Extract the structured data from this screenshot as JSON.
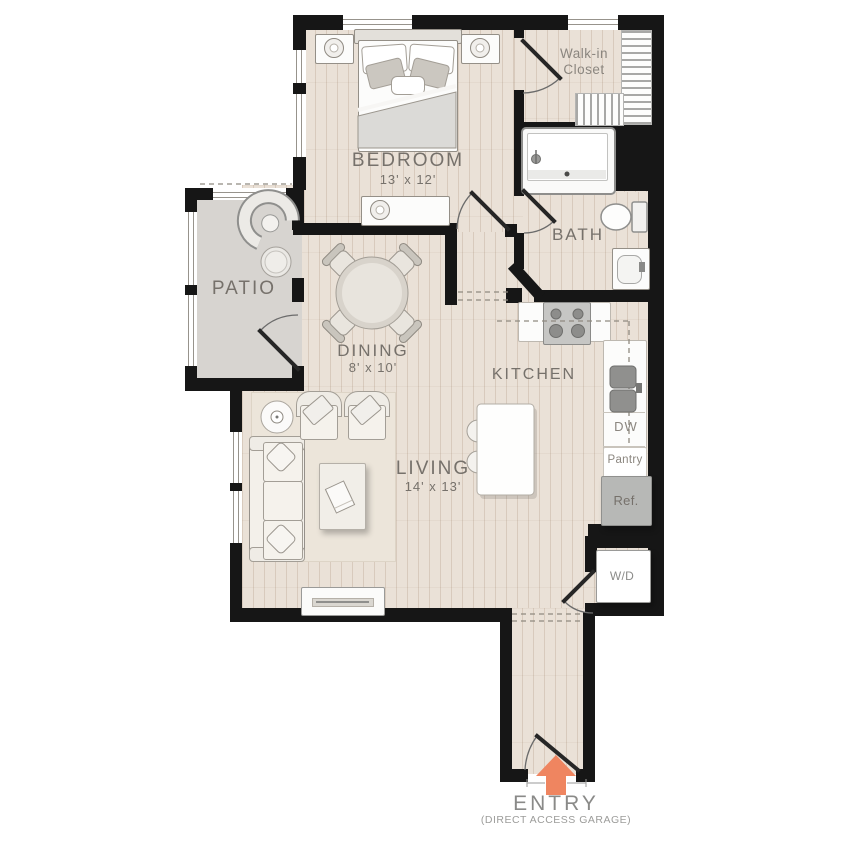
{
  "title": "Apartment floor plan",
  "rooms": {
    "bedroom": {
      "label": "BEDROOM",
      "dims": "13' x 12'"
    },
    "walk_in_closet": {
      "label": "Walk-in Closet"
    },
    "bath": {
      "label": "BATH"
    },
    "patio": {
      "label": "PATIO"
    },
    "dining": {
      "label": "DINING",
      "dims": "8' x 10'"
    },
    "kitchen": {
      "label": "KITCHEN"
    },
    "living": {
      "label": "LIVING",
      "dims": "14' x 13'"
    }
  },
  "fixtures": {
    "dishwasher": "DW",
    "pantry": "Pantry",
    "refrigerator": "Ref.",
    "washer_dryer": "W/D"
  },
  "entry": {
    "label": "ENTRY",
    "sublabel": "(DIRECT ACCESS GARAGE)"
  },
  "colors": {
    "wall": "#161616",
    "wood_floor": "#eae1d7",
    "patio_floor": "#d7d4d0",
    "entry_arrow": "#ef8560",
    "label_text": "#76716b"
  }
}
